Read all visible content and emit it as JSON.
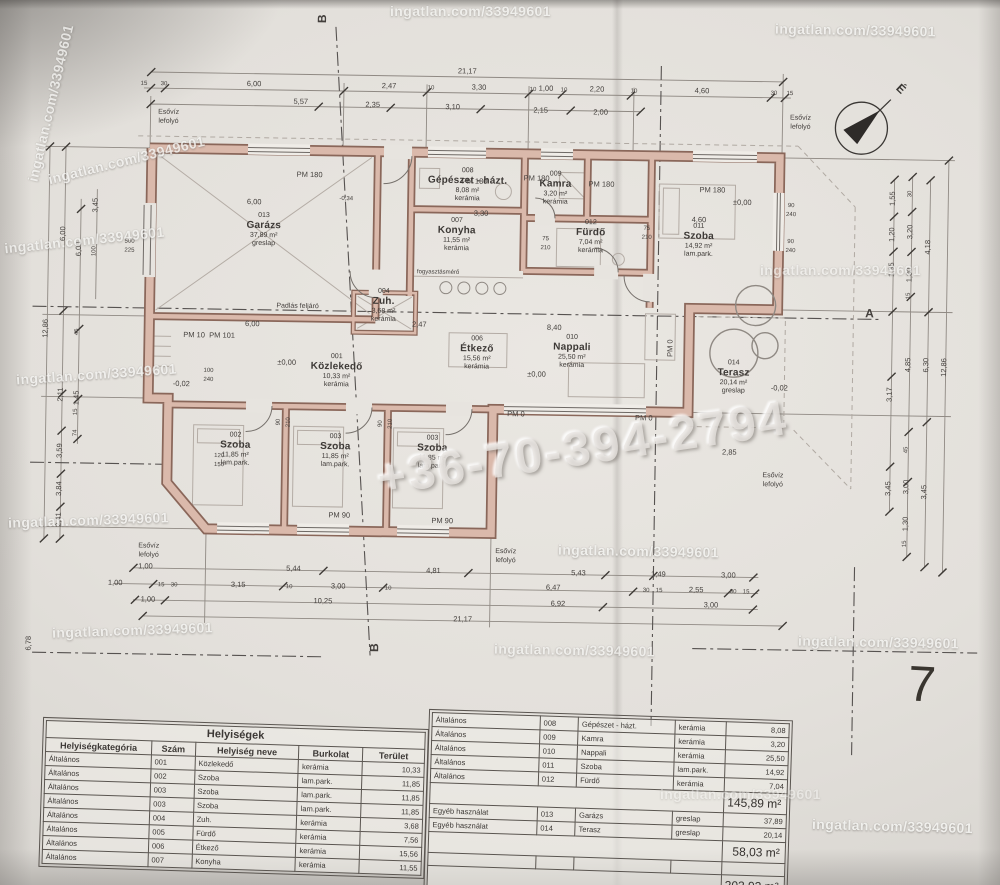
{
  "watermark": {
    "site": "ingatlan.com/33949601",
    "phone": "+36-70-394-2794",
    "stamps": [
      {
        "x": 390,
        "y": 3,
        "r": 0,
        "o": 0.8
      },
      {
        "x": 775,
        "y": 22,
        "r": 1,
        "o": 0.85
      },
      {
        "x": -30,
        "y": 95,
        "r": -77,
        "o": 0.8
      },
      {
        "x": 46,
        "y": 152,
        "r": -14,
        "o": 0.85
      },
      {
        "x": 4,
        "y": 232,
        "r": -6,
        "o": 0.8
      },
      {
        "x": 16,
        "y": 366,
        "r": -4,
        "o": 0.85
      },
      {
        "x": 8,
        "y": 512,
        "r": -2,
        "o": 0.85
      },
      {
        "x": 760,
        "y": 262,
        "r": 0,
        "o": 0.65
      },
      {
        "x": 558,
        "y": 543,
        "r": 1,
        "o": 0.85
      },
      {
        "x": 52,
        "y": 622,
        "r": -2,
        "o": 0.8
      },
      {
        "x": 494,
        "y": 642,
        "r": 1,
        "o": 0.75
      },
      {
        "x": 798,
        "y": 634,
        "r": 1,
        "o": 0.8
      },
      {
        "x": 812,
        "y": 818,
        "r": 1.5,
        "o": 0.9
      },
      {
        "x": 660,
        "y": 786,
        "r": 0,
        "o": 0.45
      }
    ]
  },
  "page_number": "7",
  "compass_label": "É",
  "plan": {
    "rooms": [
      {
        "num": "013",
        "name": "Garázs",
        "area": "37,89 m²",
        "floor": "greslap",
        "x": 265,
        "y": 228
      },
      {
        "num": "008",
        "name": "Gépészet - házt.",
        "area": "8,08 m²",
        "floor": "kerámia",
        "x": 468,
        "y": 180
      },
      {
        "num": "007",
        "name": "Konyha",
        "area": "11,55 m²",
        "floor": "kerámia",
        "x": 458,
        "y": 230
      },
      {
        "num": "009",
        "name": "Kamra",
        "area": "3,20 m²",
        "floor": "kerámia",
        "x": 556,
        "y": 182
      },
      {
        "num": "012",
        "name": "Fürdő",
        "area": "7,04 m²",
        "floor": "kerámia",
        "x": 592,
        "y": 230
      },
      {
        "num": "011",
        "name": "Szoba",
        "area": "14,92 m²",
        "floor": "lam.park.",
        "x": 700,
        "y": 232
      },
      {
        "num": "006",
        "name": "Étkező",
        "area": "15,56 m²",
        "floor": "kerámia",
        "x": 480,
        "y": 348
      },
      {
        "num": "010",
        "name": "Nappali",
        "area": "25,50 m²",
        "floor": "kerámia",
        "x": 575,
        "y": 345
      },
      {
        "num": "001",
        "name": "Közlekedő",
        "area": "10,33 m²",
        "floor": "kerámia",
        "x": 340,
        "y": 368
      },
      {
        "num": "004",
        "name": "Zuh.",
        "area": "3,68 m²",
        "floor": "kerámia",
        "x": 386,
        "y": 302
      },
      {
        "num": "002",
        "name": "Szoba",
        "area": "11,85 m²",
        "floor": "lam.park.",
        "x": 240,
        "y": 448
      },
      {
        "num": "003",
        "name": "Szoba",
        "area": "11,85 m²",
        "floor": "lam.park.",
        "x": 340,
        "y": 448
      },
      {
        "num": "003",
        "name": "Szoba",
        "area": "11,85 m²",
        "floor": "lam.park.",
        "x": 437,
        "y": 448
      },
      {
        "num": "014",
        "name": "Terasz",
        "area": "20,14 m²",
        "floor": "greslap",
        "x": 737,
        "y": 368
      }
    ],
    "dims": [
      {
        "t": "21,17",
        "x": 466,
        "y": 66
      },
      {
        "t": "15",
        "x": 143,
        "y": 84,
        "s": 6
      },
      {
        "t": "30",
        "x": 163,
        "y": 84,
        "s": 6
      },
      {
        "t": "6,00",
        "x": 253,
        "y": 82
      },
      {
        "t": "2,47",
        "x": 388,
        "y": 82
      },
      {
        "t": "3,30",
        "x": 478,
        "y": 82
      },
      {
        "t": "1,00",
        "x": 545,
        "y": 82
      },
      {
        "t": "2,20",
        "x": 596,
        "y": 82
      },
      {
        "t": "4,60",
        "x": 701,
        "y": 82
      },
      {
        "t": "10",
        "x": 430,
        "y": 84,
        "s": 6
      },
      {
        "t": "10",
        "x": 532,
        "y": 84,
        "s": 6
      },
      {
        "t": "10",
        "x": 563,
        "y": 84,
        "s": 6
      },
      {
        "t": "10",
        "x": 633,
        "y": 84,
        "s": 6
      },
      {
        "t": "30",
        "x": 773,
        "y": 84,
        "s": 6
      },
      {
        "t": "15",
        "x": 789,
        "y": 84,
        "s": 6
      },
      {
        "t": "5,57",
        "x": 300,
        "y": 99
      },
      {
        "t": "2,35",
        "x": 372,
        "y": 101
      },
      {
        "t": "3,10",
        "x": 452,
        "y": 102
      },
      {
        "t": "2,15",
        "x": 540,
        "y": 104
      },
      {
        "t": "2,00",
        "x": 600,
        "y": 105
      },
      {
        "t": "Esővíz",
        "x": 168,
        "y": 112,
        "s": 7
      },
      {
        "t": "lefolyó",
        "x": 168,
        "y": 121,
        "s": 7
      },
      {
        "t": "Esővíz",
        "x": 800,
        "y": 108,
        "s": 7
      },
      {
        "t": "lefolyó",
        "x": 800,
        "y": 117,
        "s": 7
      },
      {
        "t": "Esővíz",
        "x": 778,
        "y": 466,
        "s": 7
      },
      {
        "t": "lefolyó",
        "x": 778,
        "y": 475,
        "s": 7
      },
      {
        "t": "Esővíz",
        "x": 155,
        "y": 546,
        "s": 7
      },
      {
        "t": "lefolyó",
        "x": 155,
        "y": 555,
        "s": 7
      },
      {
        "t": "Esővíz",
        "x": 512,
        "y": 546,
        "s": 7
      },
      {
        "t": "lefolyó",
        "x": 512,
        "y": 555,
        "s": 7
      },
      {
        "t": "PM 180",
        "x": 310,
        "y": 172
      },
      {
        "t": "PM 180",
        "x": 475,
        "y": 176
      },
      {
        "t": "PM 180",
        "x": 537,
        "y": 172
      },
      {
        "t": "PM 180",
        "x": 602,
        "y": 177
      },
      {
        "t": "PM 180",
        "x": 713,
        "y": 181
      },
      {
        "t": "PM 10",
        "x": 197,
        "y": 334
      },
      {
        "t": "PM 101",
        "x": 225,
        "y": 334
      },
      {
        "t": "PM 90",
        "x": 345,
        "y": 512
      },
      {
        "t": "PM 90",
        "x": 448,
        "y": 516
      },
      {
        "t": "PM 0",
        "x": 520,
        "y": 408
      },
      {
        "t": "PM 0",
        "x": 648,
        "y": 410
      },
      {
        "t": "PM 0",
        "x": 673,
        "y": 340,
        "r": -90
      },
      {
        "t": "±0,00",
        "x": 290,
        "y": 360
      },
      {
        "t": "±0,00",
        "x": 540,
        "y": 368
      },
      {
        "t": "±0,00",
        "x": 743,
        "y": 193
      },
      {
        "t": "-0,02",
        "x": 783,
        "y": 378
      },
      {
        "t": "-0,02",
        "x": 185,
        "y": 383
      },
      {
        "t": "-0,34",
        "x": 347,
        "y": 196,
        "s": 6
      },
      {
        "t": "Padlás feljáró",
        "x": 300,
        "y": 304,
        "s": 7
      },
      {
        "t": "fogyasztásmérő",
        "x": 440,
        "y": 268,
        "s": 6
      },
      {
        "t": "6,00",
        "x": 255,
        "y": 200
      },
      {
        "t": "6,00",
        "x": 255,
        "y": 322
      },
      {
        "t": "3,30",
        "x": 482,
        "y": 208
      },
      {
        "t": "8,40",
        "x": 557,
        "y": 321
      },
      {
        "t": "2,47",
        "x": 422,
        "y": 320
      },
      {
        "t": "4,60",
        "x": 700,
        "y": 211
      },
      {
        "t": "2,85",
        "x": 734,
        "y": 443
      },
      {
        "t": "90",
        "x": 792,
        "y": 196,
        "s": 6
      },
      {
        "t": "240",
        "x": 792,
        "y": 205,
        "s": 6
      },
      {
        "t": "90",
        "x": 792,
        "y": 232,
        "s": 6
      },
      {
        "t": "240",
        "x": 792,
        "y": 241,
        "s": 6
      },
      {
        "t": "100",
        "x": 212,
        "y": 370,
        "s": 6
      },
      {
        "t": "240",
        "x": 212,
        "y": 379,
        "s": 6
      },
      {
        "t": "120",
        "x": 224,
        "y": 455,
        "s": 6
      },
      {
        "t": "150",
        "x": 224,
        "y": 464,
        "s": 6
      },
      {
        "t": "75",
        "x": 547,
        "y": 233,
        "s": 6
      },
      {
        "t": "210",
        "x": 547,
        "y": 242,
        "s": 6
      },
      {
        "t": "75",
        "x": 648,
        "y": 221,
        "s": 6
      },
      {
        "t": "210",
        "x": 648,
        "y": 230,
        "s": 6
      },
      {
        "t": "90",
        "x": 283,
        "y": 420,
        "r": -90,
        "s": 6
      },
      {
        "t": "210",
        "x": 293,
        "y": 420,
        "r": -90,
        "s": 6
      },
      {
        "t": "90",
        "x": 385,
        "y": 420,
        "r": -90,
        "s": 6
      },
      {
        "t": "210",
        "x": 395,
        "y": 420,
        "r": -90,
        "s": 6
      },
      {
        "t": "500",
        "x": 131,
        "y": 242,
        "s": 6
      },
      {
        "t": "225",
        "x": 131,
        "y": 251,
        "s": 6
      },
      {
        "t": "12,86",
        "x": 48,
        "y": 330,
        "r": -90
      },
      {
        "t": "6,00",
        "x": 64,
        "y": 235,
        "r": -90
      },
      {
        "t": "2,11",
        "x": 64,
        "y": 396,
        "r": -90
      },
      {
        "t": "3,59",
        "x": 64,
        "y": 452,
        "r": -90
      },
      {
        "t": "3,84",
        "x": 64,
        "y": 490,
        "r": -90
      },
      {
        "t": "2,41",
        "x": 64,
        "y": 521,
        "r": -90
      },
      {
        "t": "6,00",
        "x": 80,
        "y": 250,
        "r": -90
      },
      {
        "t": "45",
        "x": 80,
        "y": 333,
        "r": -90,
        "s": 6
      },
      {
        "t": "1,45",
        "x": 80,
        "y": 399,
        "r": -90
      },
      {
        "t": "15",
        "x": 80,
        "y": 413,
        "r": -90,
        "s": 6
      },
      {
        "t": "74",
        "x": 80,
        "y": 434,
        "r": -90,
        "s": 6
      },
      {
        "t": "3,45",
        "x": 96,
        "y": 206,
        "r": -90
      },
      {
        "t": "100",
        "x": 96,
        "y": 252,
        "r": -90,
        "s": 6
      },
      {
        "t": "6,78",
        "x": 36,
        "y": 645,
        "r": -90
      },
      {
        "t": "1,55",
        "x": 893,
        "y": 187,
        "r": -90
      },
      {
        "t": "1,20",
        "x": 893,
        "y": 223,
        "r": -90
      },
      {
        "t": "1,35",
        "x": 893,
        "y": 258,
        "r": -90
      },
      {
        "t": "3,17",
        "x": 893,
        "y": 383,
        "r": -90
      },
      {
        "t": "3,45",
        "x": 893,
        "y": 477,
        "r": -90
      },
      {
        "t": "30",
        "x": 911,
        "y": 182,
        "r": -90,
        "s": 6
      },
      {
        "t": "3,20",
        "x": 911,
        "y": 220,
        "r": -90
      },
      {
        "t": "1,30",
        "x": 911,
        "y": 263,
        "r": -90
      },
      {
        "t": "15",
        "x": 911,
        "y": 284,
        "r": -90,
        "s": 6
      },
      {
        "t": "4,85",
        "x": 911,
        "y": 353,
        "r": -90
      },
      {
        "t": "45",
        "x": 911,
        "y": 438,
        "r": -90,
        "s": 6
      },
      {
        "t": "3,00",
        "x": 911,
        "y": 475,
        "r": -90
      },
      {
        "t": "1,30",
        "x": 911,
        "y": 512,
        "r": -90
      },
      {
        "t": "15",
        "x": 911,
        "y": 532,
        "r": -90,
        "s": 6
      },
      {
        "t": "4,18",
        "x": 929,
        "y": 235,
        "r": -90
      },
      {
        "t": "6,30",
        "x": 929,
        "y": 353,
        "r": -90
      },
      {
        "t": "3,45",
        "x": 929,
        "y": 480,
        "r": -90
      },
      {
        "t": "12,86",
        "x": 947,
        "y": 355,
        "r": -90
      },
      {
        "t": "1,00",
        "x": 152,
        "y": 566
      },
      {
        "t": "5,44",
        "x": 300,
        "y": 566
      },
      {
        "t": "4,81",
        "x": 440,
        "y": 566
      },
      {
        "t": "5,43",
        "x": 585,
        "y": 566
      },
      {
        "t": "1,49",
        "x": 665,
        "y": 566
      },
      {
        "t": "3,00",
        "x": 735,
        "y": 566
      },
      {
        "t": "1,00",
        "x": 122,
        "y": 583
      },
      {
        "t": "15",
        "x": 168,
        "y": 585,
        "s": 6
      },
      {
        "t": "30",
        "x": 181,
        "y": 585,
        "s": 6
      },
      {
        "t": "3,15",
        "x": 245,
        "y": 583
      },
      {
        "t": "10",
        "x": 296,
        "y": 585,
        "s": 6
      },
      {
        "t": "3,00",
        "x": 345,
        "y": 583
      },
      {
        "t": "10",
        "x": 395,
        "y": 585,
        "s": 6
      },
      {
        "t": "6,47",
        "x": 560,
        "y": 581
      },
      {
        "t": "30",
        "x": 653,
        "y": 583,
        "s": 6
      },
      {
        "t": "15",
        "x": 666,
        "y": 583,
        "s": 6
      },
      {
        "t": "2,55",
        "x": 703,
        "y": 581
      },
      {
        "t": "30",
        "x": 740,
        "y": 583,
        "s": 6
      },
      {
        "t": "15",
        "x": 753,
        "y": 583,
        "s": 6
      },
      {
        "t": "1,00",
        "x": 155,
        "y": 599
      },
      {
        "t": "10,25",
        "x": 330,
        "y": 598
      },
      {
        "t": "6,92",
        "x": 565,
        "y": 597
      },
      {
        "t": "3,00",
        "x": 718,
        "y": 596
      },
      {
        "t": "21,17",
        "x": 470,
        "y": 614
      },
      {
        "t": "A",
        "x": 872,
        "y": 302,
        "s": 12,
        "b": 1
      },
      {
        "t": "B",
        "x": 320,
        "y": 16,
        "r": -90,
        "s": 12,
        "b": 1
      },
      {
        "t": "B",
        "x": 382,
        "y": 644,
        "r": -90,
        "s": 12,
        "b": 1
      }
    ]
  },
  "tables": {
    "left": {
      "title": "Helyiségek",
      "headers": [
        "Helyiségkategória",
        "Szám",
        "Helyiség neve",
        "Burkolat",
        "Terület"
      ],
      "rows": [
        [
          "Általános",
          "001",
          "Közlekedő",
          "kerámia",
          "10,33"
        ],
        [
          "Általános",
          "002",
          "Szoba",
          "lam.park.",
          "11,85"
        ],
        [
          "Általános",
          "003",
          "Szoba",
          "lam.park.",
          "11,85"
        ],
        [
          "Általános",
          "003",
          "Szoba",
          "lam.park.",
          "11,85"
        ],
        [
          "Általános",
          "004",
          "Zuh.",
          "kerámia",
          "3,68"
        ],
        [
          "Általános",
          "005",
          "Fürdő",
          "kerámia",
          "7,56"
        ],
        [
          "Általános",
          "006",
          "Étkező",
          "kerámia",
          "15,56"
        ],
        [
          "Általános",
          "007",
          "Konyha",
          "kerámia",
          "11,55"
        ]
      ]
    },
    "right": {
      "rows_general": [
        [
          "Általános",
          "008",
          "Gépészet - házt.",
          "kerámia",
          "8,08"
        ],
        [
          "Általános",
          "009",
          "Kamra",
          "kerámia",
          "3,20"
        ],
        [
          "Általános",
          "010",
          "Nappali",
          "kerámia",
          "25,50"
        ],
        [
          "Általános",
          "011",
          "Szoba",
          "lam.park.",
          "14,92"
        ],
        [
          "Általános",
          "012",
          "Fürdő",
          "kerámia",
          "7,04"
        ]
      ],
      "subtotal_general": "145,89 m²",
      "rows_other": [
        [
          "Egyéb használat",
          "013",
          "Garázs",
          "greslap",
          "37,89"
        ],
        [
          "Egyéb használat",
          "014",
          "Terasz",
          "greslap",
          "20,14"
        ]
      ],
      "subtotal_other": "58,03 m²",
      "total": "203,92 m²"
    }
  }
}
